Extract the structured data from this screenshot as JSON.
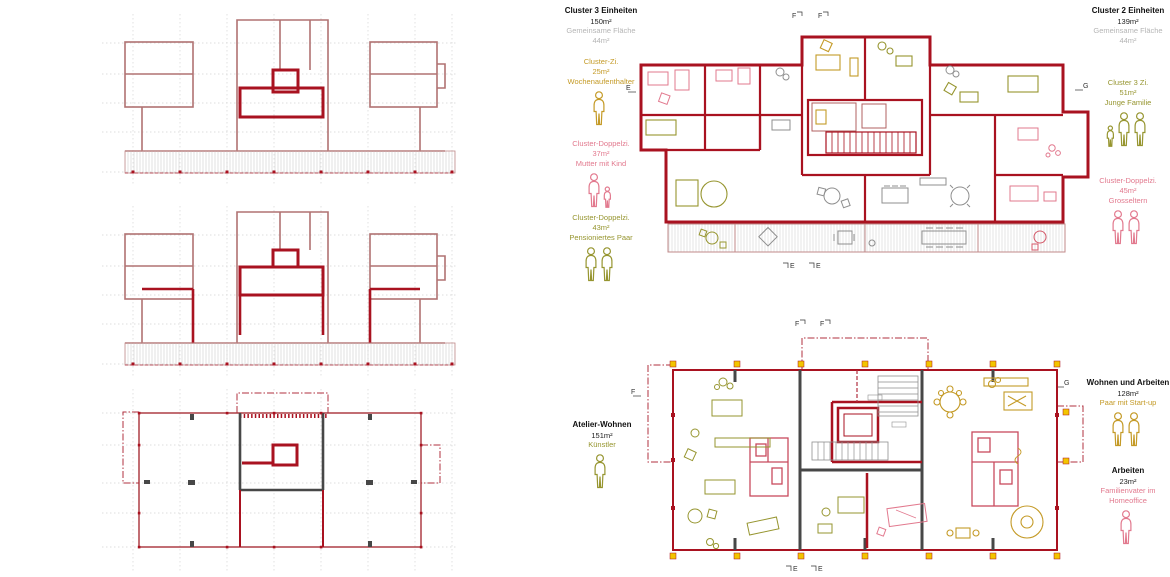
{
  "colors": {
    "gold": "#c49a26",
    "pink": "#e2798e",
    "olive": "#96952f",
    "red_bold": "#a91220",
    "red_thin": "#b07272",
    "gray_wall": "#474747",
    "yellow": "#f2c500",
    "furn_gray": "#8f8f8f",
    "gray_text": "#b5b5b5"
  },
  "markers": {
    "f": "F",
    "e": "E",
    "g": "G"
  },
  "annotations": {
    "cluster3": {
      "title": "Cluster 3 Einheiten",
      "area": "150m²",
      "shared_label": "Gemeinsame Fläche",
      "shared_area": "44m²",
      "rooms": [
        {
          "name": "Cluster-Zi.",
          "area": "25m²",
          "occupant": "Wochenaufenthalter",
          "color": "gold",
          "figures": "a"
        },
        {
          "name": "Cluster-Doppelzi.",
          "area": "37m²",
          "occupant": "Mutter mit Kind",
          "color": "pink",
          "figures": "ac"
        },
        {
          "name": "Cluster-Doppelzi.",
          "area": "43m²",
          "occupant": "Pensioniertes Paar",
          "color": "olive",
          "figures": "aa"
        }
      ]
    },
    "cluster2": {
      "title": "Cluster 2 Einheiten",
      "area": "139m²",
      "shared_label": "Gemeinsame Fläche",
      "shared_area": "44m²",
      "rooms": [
        {
          "name": "Cluster 3 Zi.",
          "area": "51m²",
          "occupant": "Junge Familie",
          "color": "olive",
          "figures": "caa"
        },
        {
          "name": "Cluster-Doppelzi.",
          "area": "45m²",
          "occupant": "Grosseltern",
          "color": "pink",
          "figures": "aa"
        }
      ]
    },
    "atelier": {
      "title": "Atelier-Wohnen",
      "area": "151m²",
      "occupant": "Künstler",
      "color": "olive",
      "figures": "a"
    },
    "wohnen": {
      "title": "Wohnen und Arbeiten",
      "area": "128m²",
      "occupant": "Paar mit Start-up",
      "color": "gold",
      "figures": "aa"
    },
    "arbeiten": {
      "title": "Arbeiten",
      "area": "23m²",
      "occupant": "Familienvater im Homeoffice",
      "color": "pink",
      "figures": "a"
    }
  }
}
